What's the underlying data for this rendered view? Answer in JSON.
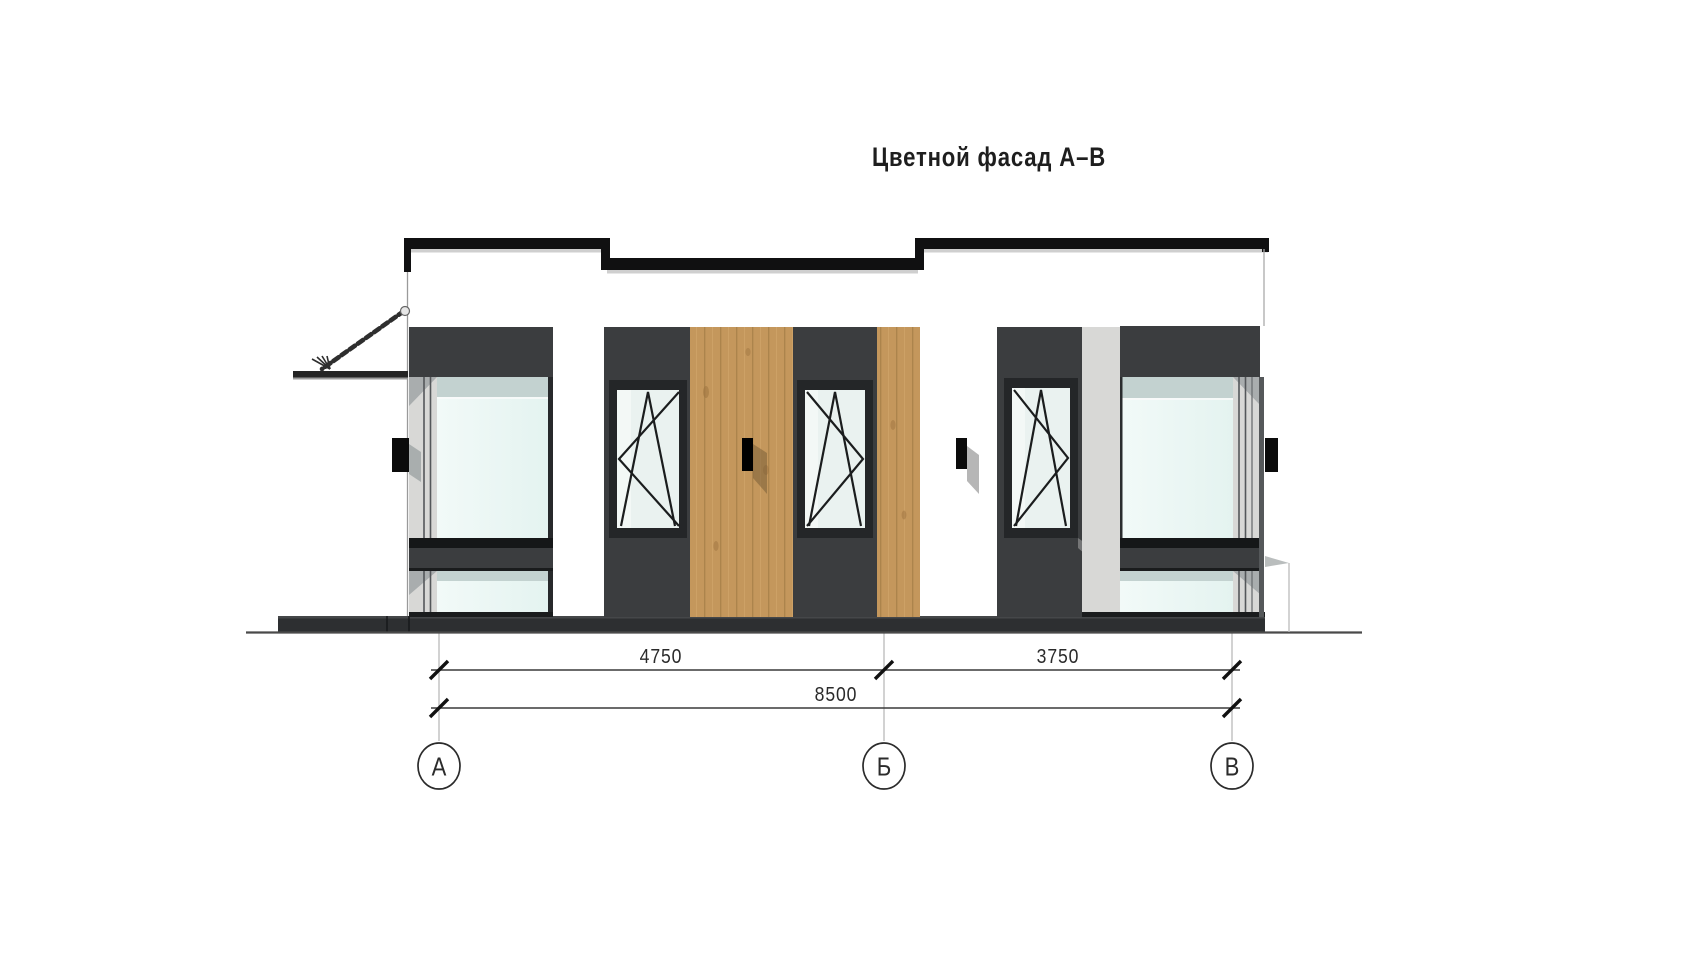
{
  "drawing": {
    "title": "Цветной фасад А–В"
  },
  "dimensions": {
    "segments": [
      {
        "from": "А",
        "to": "Б",
        "label": "4750"
      },
      {
        "from": "Б",
        "to": "В",
        "label": "3750"
      }
    ],
    "overall": {
      "from": "А",
      "to": "В",
      "label": "8500"
    }
  },
  "axes": {
    "a": "А",
    "b": "Б",
    "v": "В"
  },
  "colors": {
    "background": "#ffffff",
    "parapet_black": "#101011",
    "panel_dark_gray": "#3b3d3f",
    "window_frame": "#232527",
    "glass": "#e9f6f3",
    "glass_top_band": "#c3d2d0",
    "spandrel_black_band": "#151718",
    "wood": "#c4975c",
    "wood_plank_line": "#a07944",
    "light_gray_strip": "#d8d8d6",
    "plinth": "#2d2f31",
    "dimension_line": "#3a3a3a",
    "extension_line": "#b3b3b3",
    "fixture_black": "#0b0b0b"
  }
}
